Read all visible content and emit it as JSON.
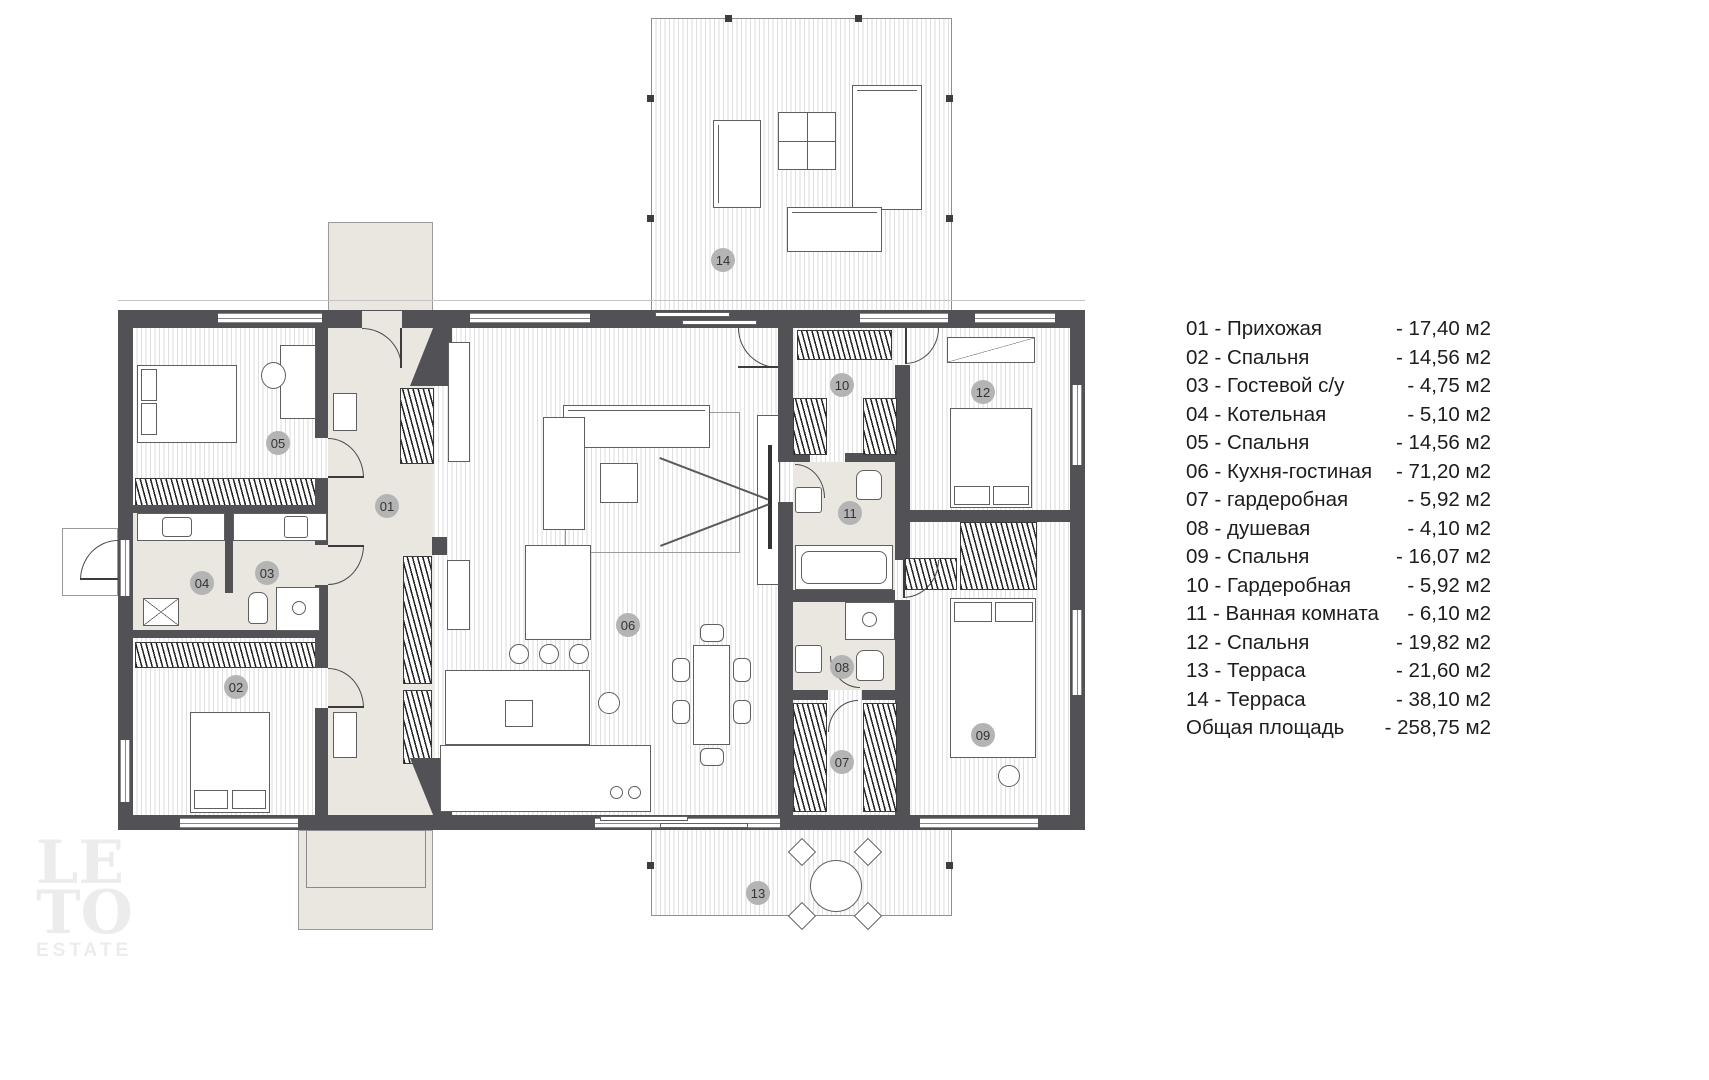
{
  "legend": {
    "items": [
      {
        "label": "01 - Прихожая",
        "area": "- 17,40 м2"
      },
      {
        "label": "02 - Спальня",
        "area": "- 14,56 м2"
      },
      {
        "label": "03 - Гостевой с/у",
        "area": "- 4,75 м2"
      },
      {
        "label": "04 - Котельная",
        "area": "- 5,10 м2"
      },
      {
        "label": "05 - Спальня",
        "area": "- 14,56 м2"
      },
      {
        "label": "06 - Кухня-гостиная",
        "area": "- 71,20 м2"
      },
      {
        "label": "07 - гардеробная",
        "area": "- 5,92 м2"
      },
      {
        "label": "08 - душевая",
        "area": "- 4,10 м2"
      },
      {
        "label": "09 - Спальня",
        "area": "- 16,07 м2"
      },
      {
        "label": "10 - Гардеробная",
        "area": "- 5,92 м2"
      },
      {
        "label": "11 - Ванная комната",
        "area": "- 6,10 м2"
      },
      {
        "label": "12 - Спальня",
        "area": "- 19,82 м2"
      },
      {
        "label": "13 - Терраса",
        "area": "- 21,60 м2"
      },
      {
        "label": "14 - Терраса",
        "area": "- 38,10 м2"
      },
      {
        "label": "Общая площадь",
        "area": "- 258,75 м2"
      }
    ]
  },
  "plan": {
    "labels": [
      {
        "num": "01"
      },
      {
        "num": "02"
      },
      {
        "num": "03"
      },
      {
        "num": "04"
      },
      {
        "num": "05"
      },
      {
        "num": "06"
      },
      {
        "num": "07"
      },
      {
        "num": "08"
      },
      {
        "num": "09"
      },
      {
        "num": "10"
      },
      {
        "num": "11"
      },
      {
        "num": "12"
      },
      {
        "num": "13"
      },
      {
        "num": "14"
      }
    ]
  },
  "watermark": {
    "line1": "LE",
    "line2": "TO",
    "line3": "ESTATE"
  },
  "colors": {
    "wall": "#515156",
    "label_circle": "#b4b4b4",
    "floor_stripe": "#dedede",
    "marble": "#eae7e1"
  }
}
